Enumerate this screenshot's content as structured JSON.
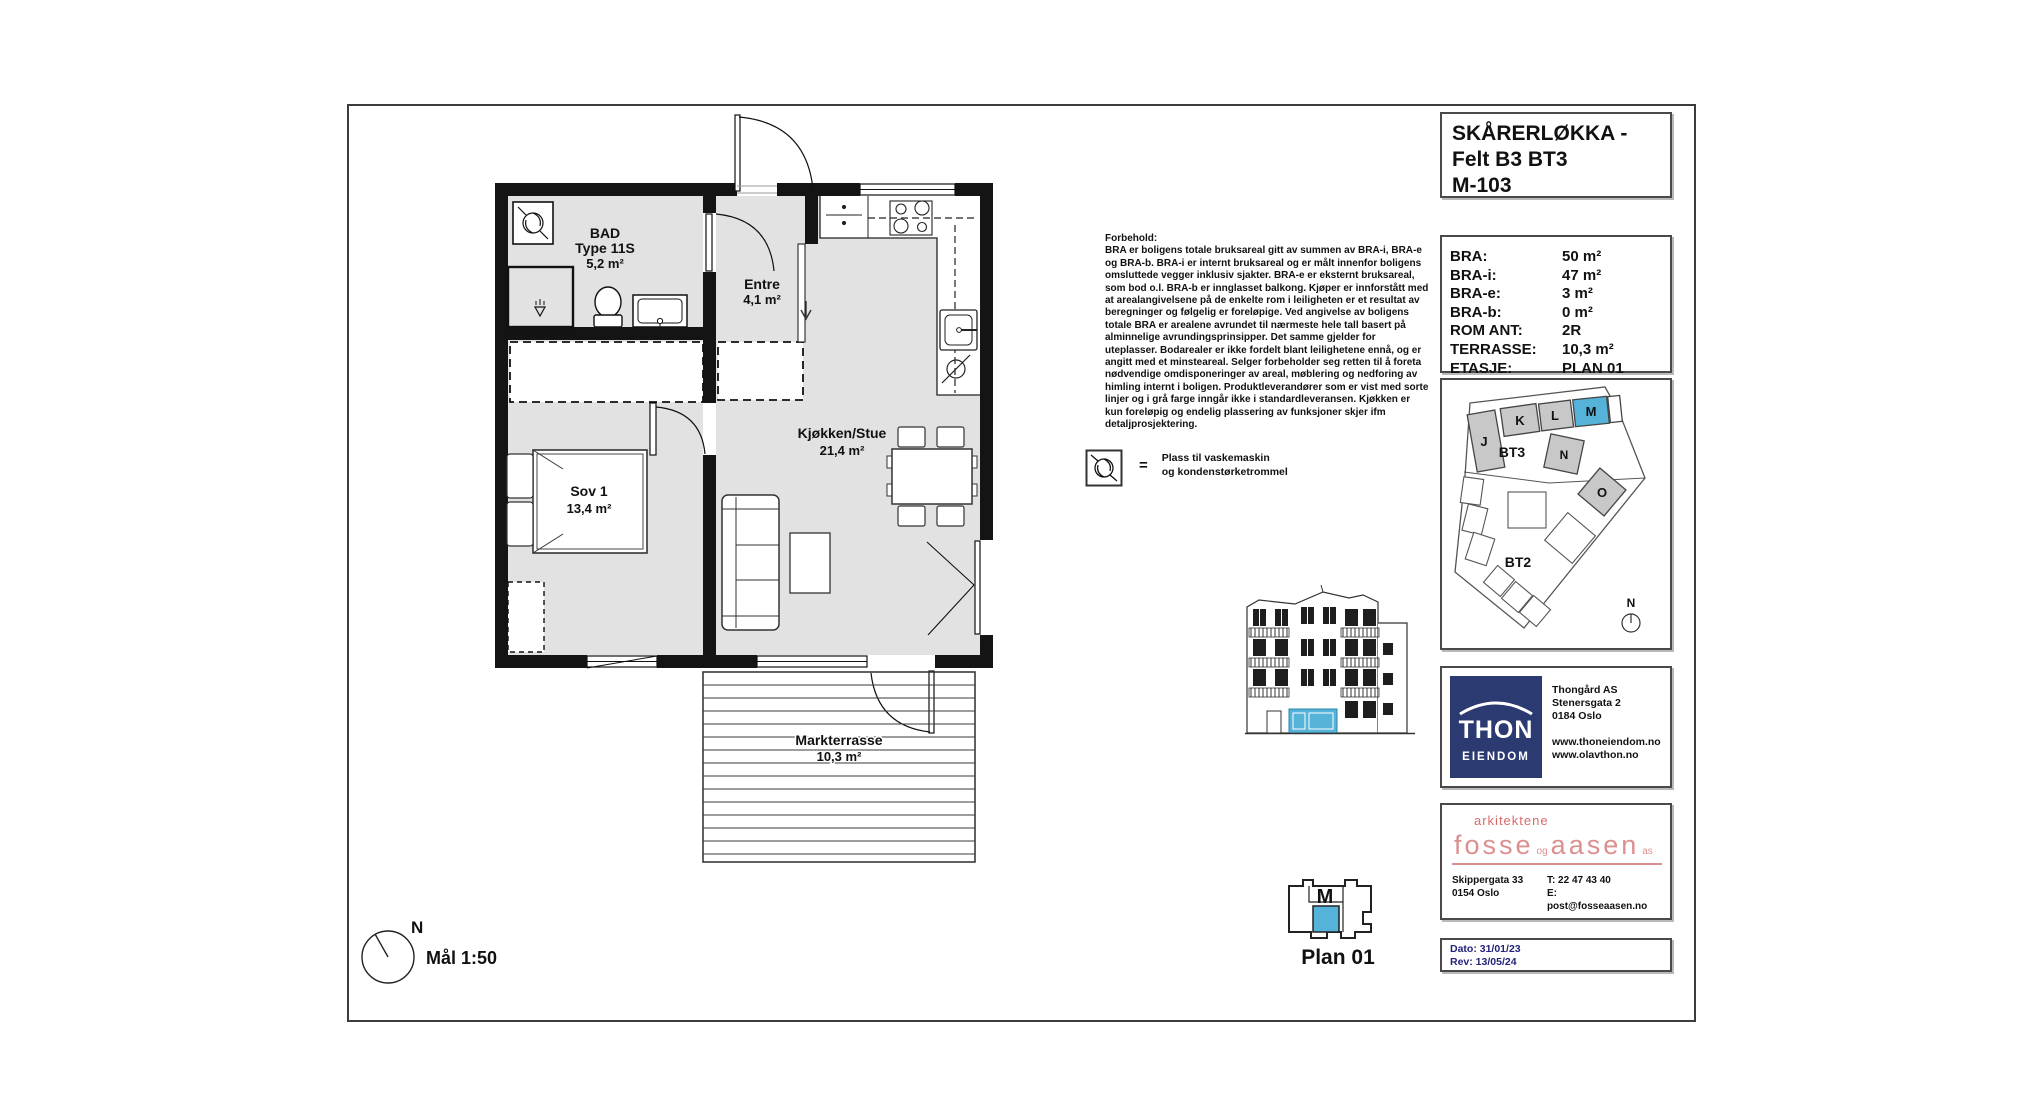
{
  "colors": {
    "highlight_blue": "#55b2d8",
    "thon_navy": "#2c3a72",
    "architect_red": "#dc8f8f",
    "dates_navy": "#23237a"
  },
  "title_block": {
    "lines": [
      "SKÅRERLØKKA -",
      "Felt B3 BT3",
      "M-103"
    ]
  },
  "info_table": {
    "rows": [
      {
        "label": "BRA:",
        "value": "50 m²"
      },
      {
        "label": "BRA-i:",
        "value": "47 m²"
      },
      {
        "label": "BRA-e:",
        "value": "3 m²"
      },
      {
        "label": "BRA-b:",
        "value": "0 m²"
      },
      {
        "label": "ROM ANT:",
        "value": "2R"
      },
      {
        "label": "TERRASSE:",
        "value": "10,3 m²"
      },
      {
        "label": "ETASJE:",
        "value": "PLAN 01"
      }
    ]
  },
  "disclaimer": {
    "heading": "Forbehold:",
    "body": "BRA er boligens totale bruksareal gitt av summen av BRA-i, BRA-e og BRA-b. BRA-i er internt bruksareal og er målt innenfor boligens omsluttede vegger inklusiv sjakter. BRA-e er eksternt bruksareal, som bod o.l. BRA-b er innglasset balkong. Kjøper er innforstått med at arealangivelsene på de enkelte rom i leiligheten er et resultat av beregninger og følgelig er foreløpige. Ved angivelse av boligens totale BRA er arealene avrundet til nærmeste hele tall basert på alminnelige avrundingsprinsipper. Det samme gjelder for uteplasser. Bodarealer er ikke fordelt blant leilighetene ennå, og er angitt med et minsteareal. Selger forbeholder seg retten til å foreta nødvendige omdisponeringer av areal, møblering og nedforing av himling internt i boligen. Produktleverandører som er vist med sorte linjer og i grå farge inngår ikke i standardleveransen. Kjøkken er kun foreløpig og endelig plassering av funksjoner skjer ifm detaljprosjektering."
  },
  "legend": {
    "equals": "=",
    "line1": "Plass til vaskemaskin",
    "line2": "og kondenstørketrommel"
  },
  "floor_plan": {
    "rooms": {
      "bad": {
        "name": "BAD",
        "type": "Type 11S",
        "area": "5,2 m²"
      },
      "entre": {
        "name": "Entre",
        "area": "4,1 m²"
      },
      "stue": {
        "name": "Kjøkken/Stue",
        "area": "21,4 m²"
      },
      "sov": {
        "name": "Sov 1",
        "area": "13,4 m²"
      },
      "terrasse": {
        "name": "Markterrasse",
        "area": "10,3 m²"
      }
    }
  },
  "site_plan": {
    "blocks": {
      "j": "J",
      "k": "K",
      "l": "L",
      "m": "M",
      "n": "N",
      "o": "O"
    },
    "bt3": "BT3",
    "bt2": "BT2",
    "north": "N"
  },
  "thon": {
    "logo1": "THON",
    "logo2": "EIENDOM",
    "company": "Thongård AS",
    "street": "Stenersgata 2",
    "city": "0184 Oslo",
    "web1": "www.thoneiendom.no",
    "web2": "www.olavthon.no"
  },
  "architect": {
    "tagline": "arkitektene",
    "logo_parts": [
      "fosse",
      "og",
      "aasen",
      "as"
    ],
    "address1": "Skippergata 33",
    "address2": "0154 Oslo",
    "phone": "T: 22 47 43 40",
    "email": "E: post@fosseaasen.no"
  },
  "dates": {
    "dato": "Dato: 31/01/23",
    "rev": "Rev:  13/05/24"
  },
  "plan_marker": {
    "unit": "M",
    "caption": "Plan 01"
  },
  "compass": {
    "north": "N",
    "scale": "Mål 1:50"
  }
}
